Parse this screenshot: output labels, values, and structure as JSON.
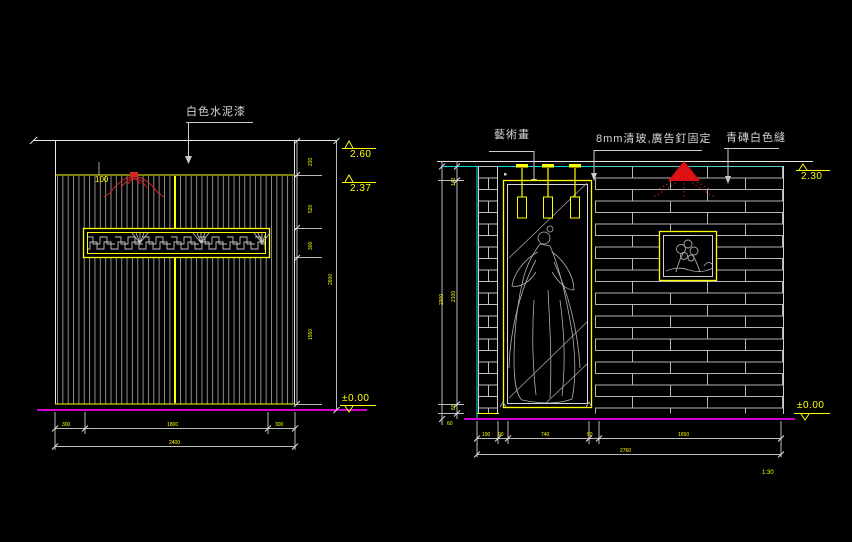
{
  "left": {
    "finish_label": "白色水泥漆",
    "lamp_dim": "100",
    "levels": {
      "top": "2.60",
      "band": "2.37",
      "floor": "±0.00"
    },
    "dims_bottom": [
      "300",
      "1800",
      "300"
    ],
    "dims_bottom_total": "2400",
    "dims_right": [
      "230",
      "520",
      "300",
      "1550"
    ],
    "dims_right_total": "2600"
  },
  "right": {
    "art_label": "藝術畫",
    "glass_label": "8mm清玻,廣告釘固定",
    "brick_label": "青磚白色縫",
    "levels": {
      "top": "2.30",
      "floor": "±0.00"
    },
    "dims_bottom": [
      "190",
      "90",
      "740",
      "90",
      "1650"
    ],
    "dims_bottom_total": "2760",
    "dims_left": [
      "140",
      "2100",
      "60"
    ],
    "dims_left_total": "2300",
    "floor_dim": "60",
    "scale_note": "1:30"
  },
  "colors": {
    "background": "#000000",
    "line_white": "#e0e0e0",
    "line_gray": "#8c8c8c",
    "brick_gray": "#b4b4b4",
    "yellow": "#ffff00",
    "magenta": "#cf00cf",
    "cyan": "#00e0e0",
    "red": "#dd1111"
  }
}
